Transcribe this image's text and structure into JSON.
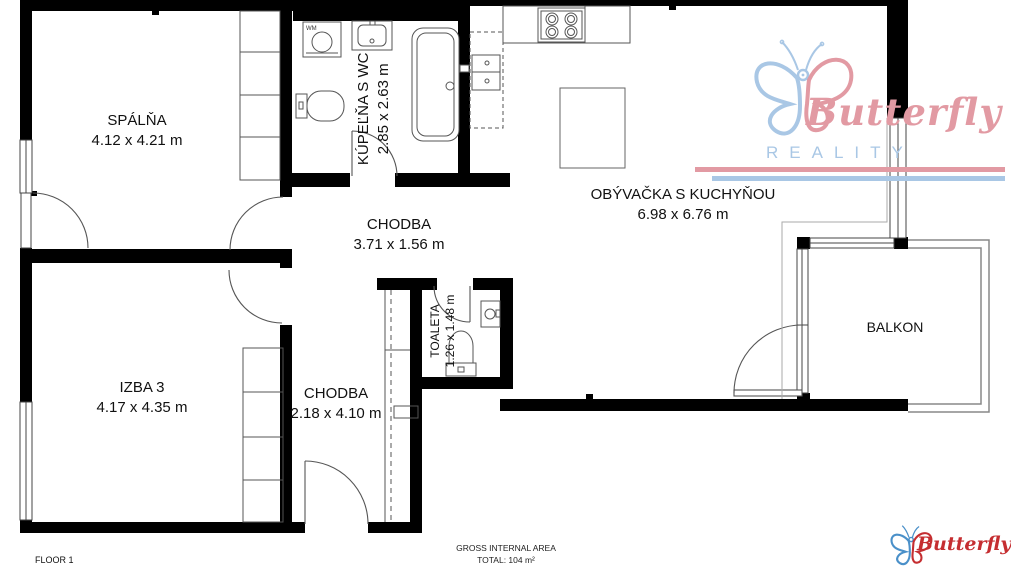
{
  "floorplan": {
    "floor_label": "FLOOR 1",
    "area_note": {
      "line1": "GROSS INTERNAL AREA",
      "line2": "TOTAL: 104 m²"
    },
    "rooms": [
      {
        "name": "SPÁLŇA",
        "dims": "4.12 x 4.21 m"
      },
      {
        "name": "KÚPEĽŇA S WC",
        "dims": "2.85 x 2.63 m"
      },
      {
        "name": "CHODBA",
        "dims": "3.71 x 1.56 m"
      },
      {
        "name": "OBÝVAČKA S KUCHYŇOU",
        "dims": "6.98 x 6.76 m"
      },
      {
        "name": "IZBA 3",
        "dims": "4.17 x 4.35 m"
      },
      {
        "name": "CHODBA",
        "dims": "2.18 x 4.10 m"
      },
      {
        "name": "TOALETA",
        "dims": "1.26 x 1.48 m"
      },
      {
        "name": "BALKON",
        "dims": ""
      }
    ],
    "fixtures": {
      "washing_machine_label": "WM"
    }
  },
  "branding": {
    "watermark": {
      "name": "Butterfly",
      "subtitle": "REALITY"
    },
    "footer_logo": {
      "name": "Butterfly"
    }
  },
  "colors": {
    "walls": "#000000",
    "watermark_pink": "#e29aa3",
    "watermark_blue": "#a9c7e5",
    "footer_red": "#c52e31",
    "footer_blue": "#4a90c9"
  }
}
